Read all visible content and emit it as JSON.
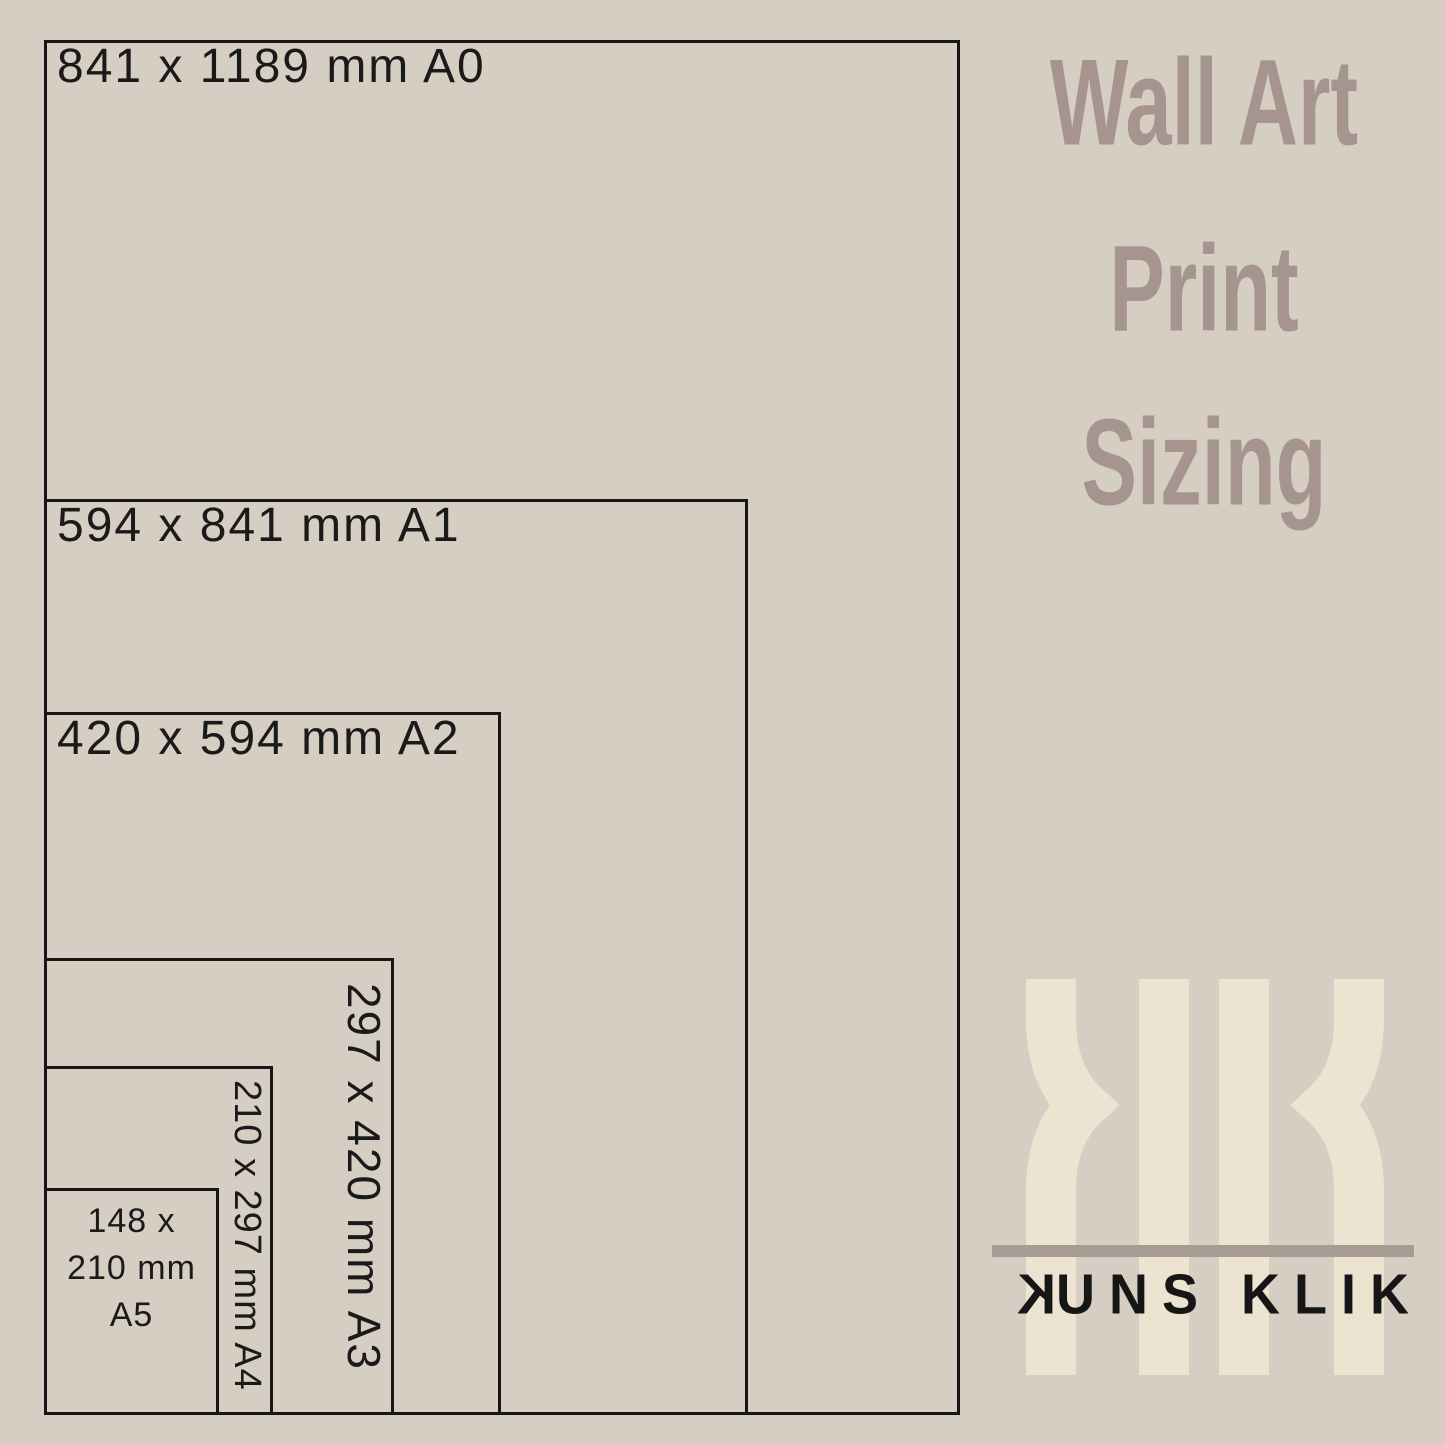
{
  "title": {
    "line1": "Wall Art",
    "line2": "Print",
    "line3": "Sizing"
  },
  "diagram": {
    "boxes": [
      {
        "name": "A0",
        "label": "841 x 1189 mm A0",
        "orientation": "horizontal"
      },
      {
        "name": "A1",
        "label": "594 x 841 mm A1",
        "orientation": "horizontal"
      },
      {
        "name": "A2",
        "label": "420 x 594 mm A2",
        "orientation": "horizontal"
      },
      {
        "name": "A3",
        "label": "297 x 420 mm A3",
        "orientation": "vertical"
      },
      {
        "name": "A4",
        "label": "210 x 297 mm A4",
        "orientation": "vertical"
      },
      {
        "name": "A5",
        "label_lines": [
          "148 x",
          "210 mm",
          "A5"
        ],
        "orientation": "horizontal"
      }
    ]
  },
  "logo": {
    "monogram": "KK",
    "wordmark": {
      "word1_first": "K",
      "word1_rest": "UNS",
      "word2": "KLIK"
    }
  },
  "colors": {
    "background": "#d6cec3",
    "title_text": "#a6948e",
    "box_border": "#161616",
    "label_text": "#1a1a1a",
    "monogram_cream": "#ece4d1",
    "divider_line": "#a89b94",
    "wordmark_text": "#161616"
  }
}
